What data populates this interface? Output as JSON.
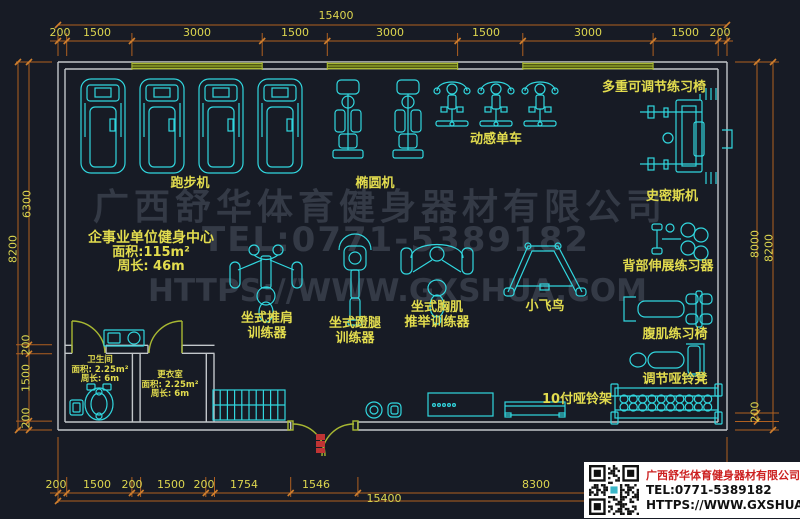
{
  "plan": {
    "gym_info": {
      "title": "企事业单位健身中心",
      "area": "面积:115m²",
      "perimeter": "周长: 46m"
    },
    "rooms": {
      "toilet": {
        "name": "卫生间",
        "area": "面积: 2.25m²",
        "perimeter": "周长: 6m"
      },
      "locker": {
        "name": "更衣室",
        "area": "面积: 2.25m²",
        "perimeter": "周长: 6m"
      }
    },
    "equipment": {
      "treadmill": "跑步机",
      "elliptical": "椭圆机",
      "spin_bike": "动感单车",
      "multi_adjust_bench": "多重可调节练习椅",
      "smith_machine": "史密斯机",
      "back_extension": "背部伸展练习器",
      "ab_chair": "腹肌练习椅",
      "adj_dumbbell_bench": "调节哑铃凳",
      "fly_bird": "小飞鸟",
      "shoulder_press_1": "坐式推肩",
      "shoulder_press_2": "训练器",
      "leg_press_1": "坐式蹬腿",
      "leg_press_2": "训练器",
      "chest_press_1": "坐式胸肌",
      "chest_press_2": "推举训练器",
      "dumbbell_rack": "10付哑铃架"
    }
  },
  "dimensions": {
    "top_total": "15400",
    "top_segments": [
      "200",
      "1500",
      "3000",
      "1500",
      "3000",
      "1500",
      "3000",
      "1500",
      "200"
    ],
    "bottom_segments": [
      "200",
      "1500",
      "200",
      "1500",
      "200",
      "1754",
      "1546",
      "8300"
    ],
    "bottom_total": "15400",
    "left_total": "8200",
    "left_segments": [
      "6300",
      "200",
      "1500",
      "200"
    ],
    "right_segments": [
      "8000",
      "200"
    ],
    "right_total": "8200"
  },
  "watermark": {
    "line1": "广西舒华体育健身器材有限公司",
    "line2": "TEL:0771-5389182",
    "line3": "HTTPS://WWW.GXSHUA.COM"
  },
  "title_block": {
    "company": "广西舒华体育健身器材有限公司",
    "tel": "TEL:0771-5389182",
    "website": "HTTPS://WWW.GXSHUA.COM"
  },
  "colors": {
    "background": "#171b25",
    "equipment_cyan": "#31d7df",
    "label_yellow": "#e2dc4e",
    "dimension_orange": "#b06020",
    "wall_grey": "#c2c6ca",
    "window_door_olive": "#a8b832",
    "watermark_grey": "#343a46",
    "entrance_red": "#c03434",
    "title_red": "#cc2020"
  }
}
